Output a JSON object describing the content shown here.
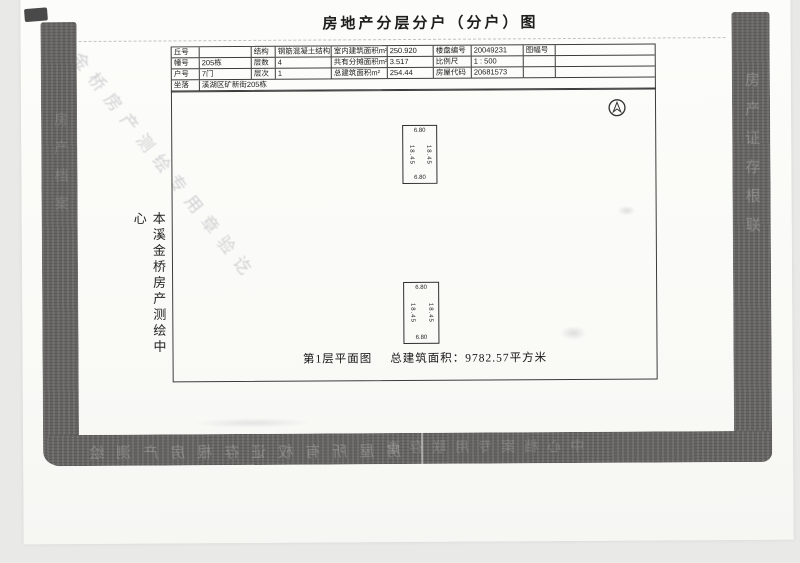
{
  "scan": {
    "background_color": "#e9e9e7",
    "paper_color": "#fbfbf8",
    "band_color": "#6b6a68",
    "line_color": "#3c3c3c"
  },
  "header": {
    "title": "房地产分层分户（分户）图"
  },
  "info_table": {
    "rows": [
      {
        "cells": [
          "丘号",
          "",
          "结构",
          "钢筋混凝土结构",
          "室内建筑面积m²",
          "250.920",
          "楼盘编号",
          "20049231",
          "图幅号",
          ""
        ]
      },
      {
        "cells": [
          "幢号",
          "205栋",
          "层数",
          "4",
          "共有分摊面积m²",
          "3.517",
          "比例尺",
          "1 : 500",
          "",
          ""
        ]
      },
      {
        "cells": [
          "户号",
          "7门",
          "层次",
          "1",
          "总建筑面积m²",
          "254.44",
          "房屋代码",
          "20681573",
          "",
          ""
        ]
      }
    ],
    "location_label": "坐落",
    "location_value": "溪湖区矿新街205栋"
  },
  "floor_plan": {
    "units": [
      {
        "width_top": "6.80",
        "width_bottom": "6.80",
        "depth_left": "18.45",
        "depth_right": "18.45"
      },
      {
        "width_top": "6.80",
        "width_bottom": "6.80",
        "depth_left": "18.45",
        "depth_right": "18.45"
      }
    ],
    "caption_title": "第1层平面图",
    "caption_area": "总建筑面积：9782.57平方米"
  },
  "side_label": "本溪金桥房产测绘中心",
  "artifacts": {
    "diagonal_bleedthrough": "金桥房产测绘专用章验讫",
    "band_bottom_bleedthrough_1": "房屋所有权证存根房产测绘",
    "band_bottom_bleedthrough_2": "中心档案专用联存查",
    "band_right_bleedthrough": "房产证存根联",
    "band_left_bleedthrough": "房产档案"
  }
}
